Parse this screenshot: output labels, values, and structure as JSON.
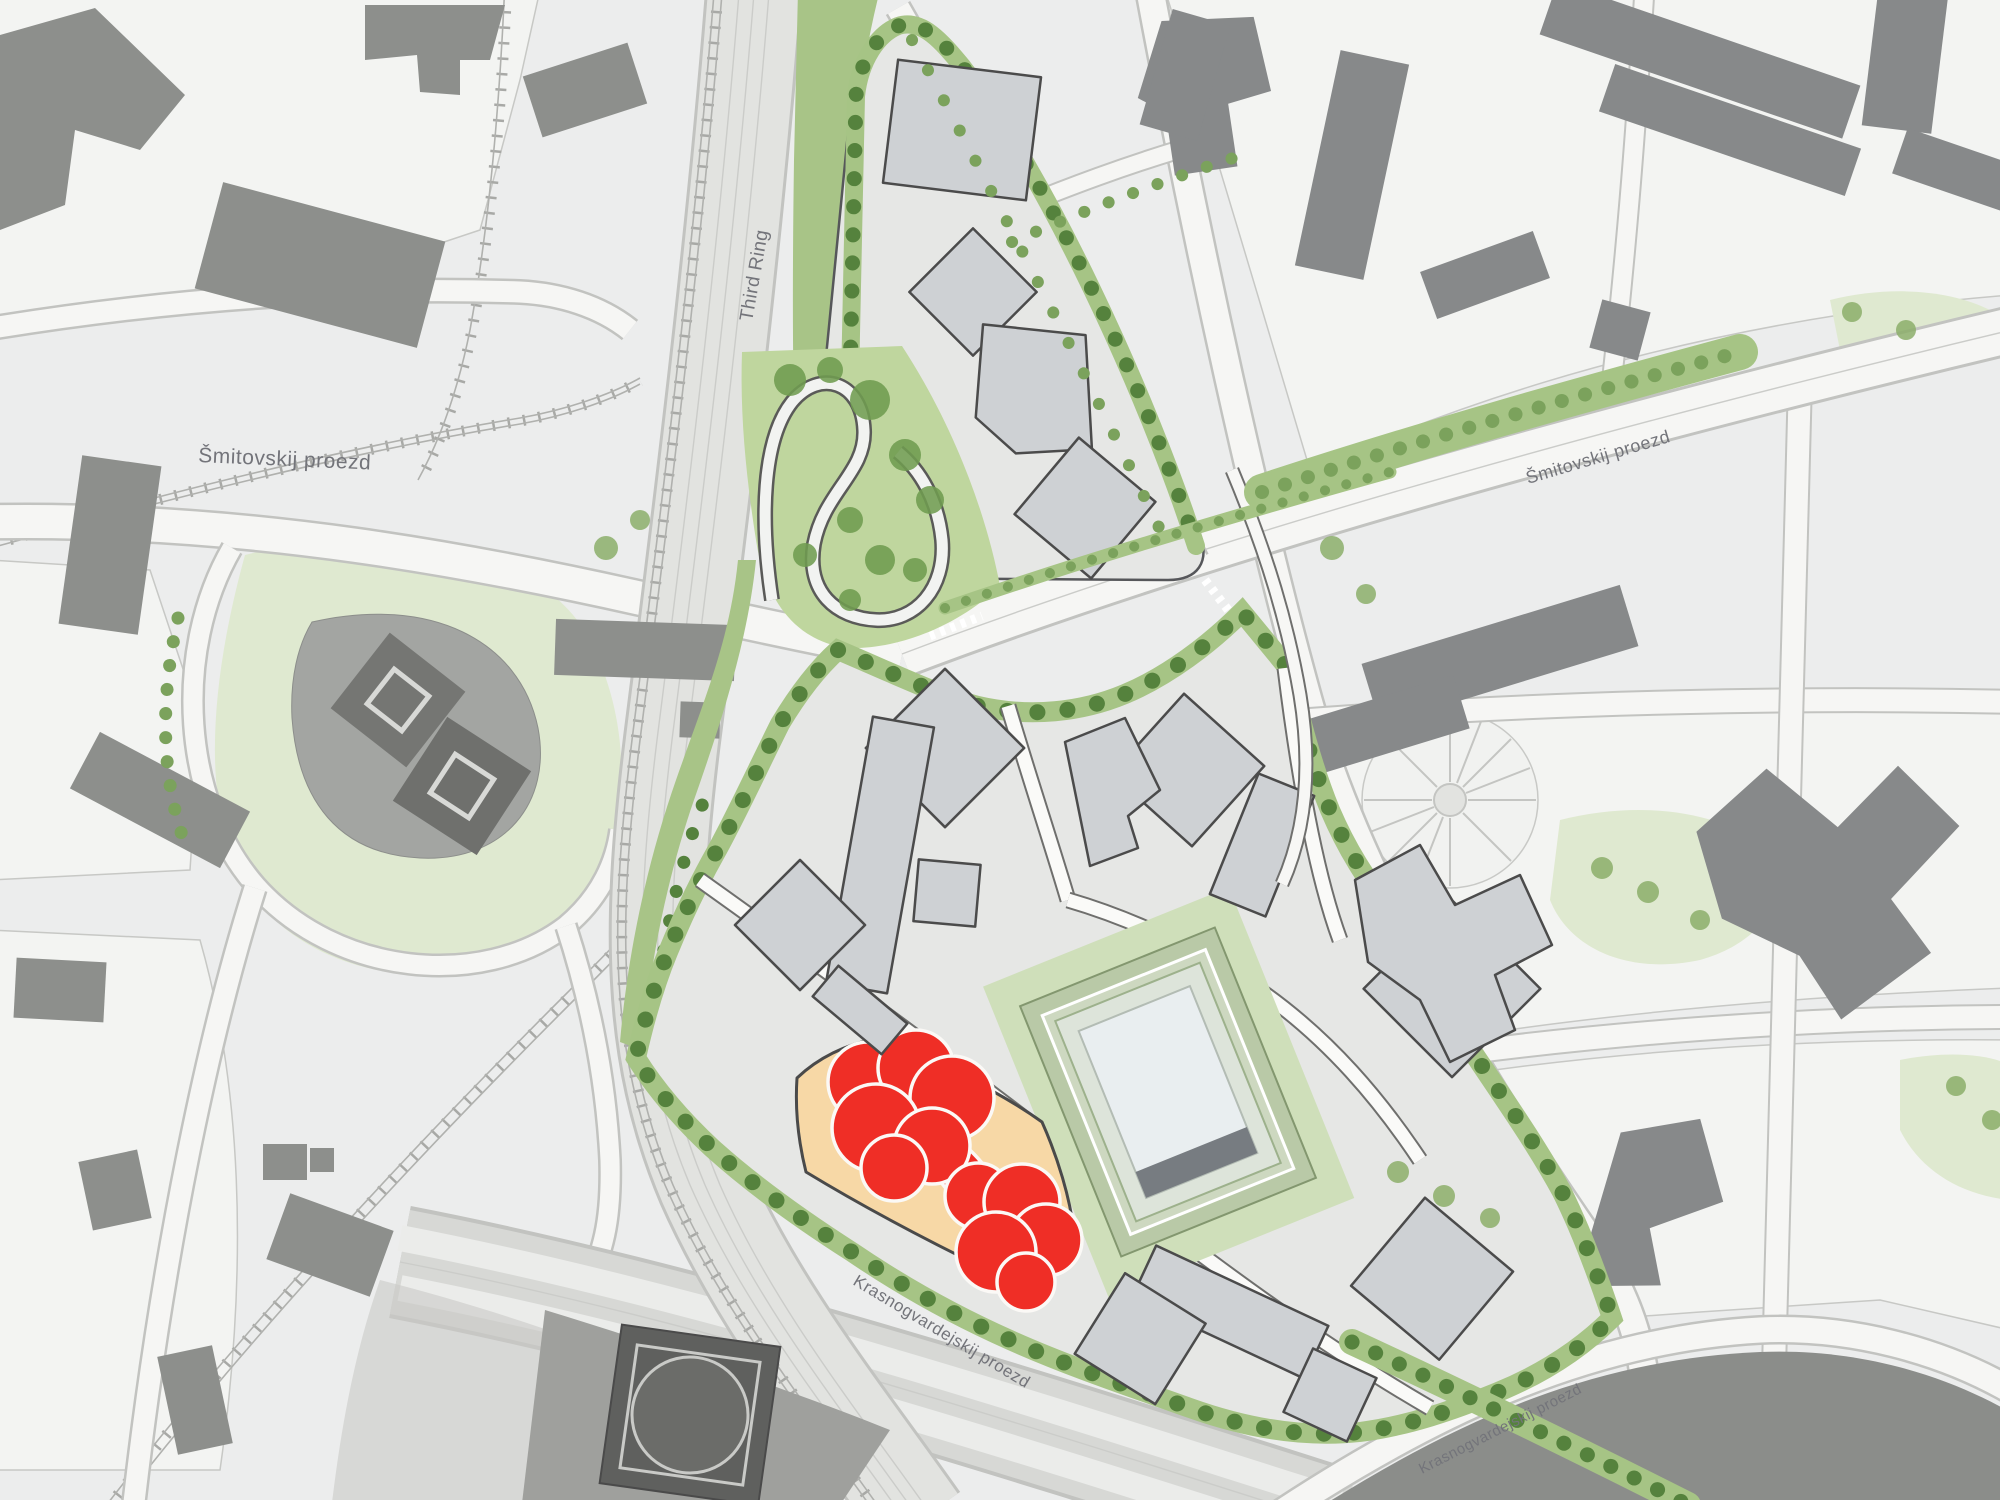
{
  "map": {
    "title": "Urban masterplan site plan",
    "labels": {
      "street_west": "Šmitovskij proezd",
      "ring_road": "Third Ring",
      "street_east": "Šmitovskij proezd",
      "street_south": "Krasnogvardejskij proezd",
      "street_south_secondary": "Krasnogvardejskij proezd"
    },
    "colors": {
      "background": "#eceded",
      "parcel": "#f3f4f2",
      "road": "#f6f6f4",
      "road_casing": "#c2c3c0",
      "context_building": "#8d8f8c",
      "site_building": "#ced1d4",
      "site_ground": "#e6e7e5",
      "green_belt": "#a6c485",
      "tree_dark": "#55823d",
      "park_wedge": "#bfd69e",
      "central_park": "#cfdfba",
      "lawn": "#dfe9d0",
      "plot_highlight": "#f7d8a6",
      "feature_red": "#ef2e26",
      "arena_frame": "#b9c9a7",
      "arena_court": "#e9eef0",
      "dark_zone": "#8b8d8a",
      "label_text": "#73747a"
    }
  }
}
